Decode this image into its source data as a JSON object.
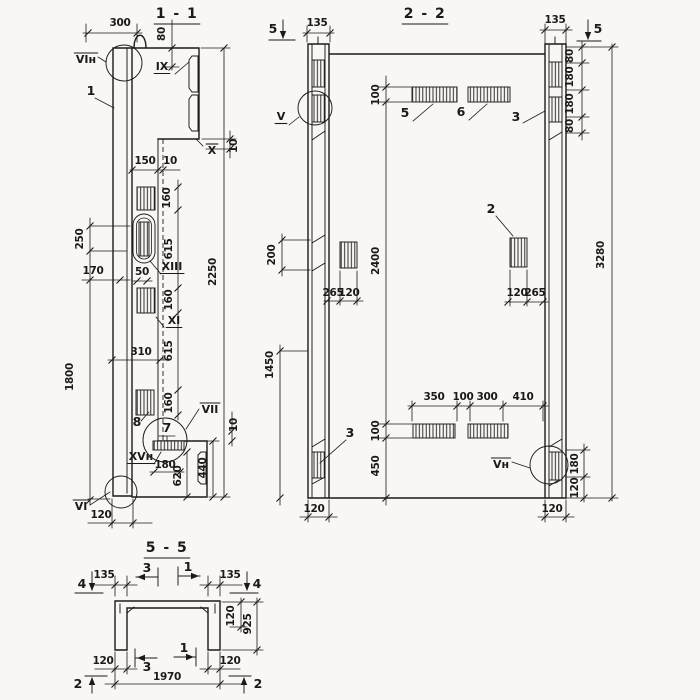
{
  "sheet": {
    "background": "#f8f7f3",
    "ink": "#1c1a18"
  },
  "sections": [
    {
      "id": "1-1",
      "name": "section-1-1",
      "labels": [
        {
          "t": "1 - 1",
          "x": 177,
          "y": 18,
          "k": "title",
          "ln": "u"
        },
        {
          "t": "300",
          "x": 120,
          "y": 26,
          "k": "dim"
        },
        {
          "t": "VIн",
          "x": 86,
          "y": 63,
          "k": "detail",
          "ln": "o"
        },
        {
          "t": "1",
          "x": 91,
          "y": 95,
          "k": "part"
        },
        {
          "t": "80",
          "x": 165,
          "y": 34,
          "k": "dim",
          "r": -90
        },
        {
          "t": "IX",
          "x": 162,
          "y": 70,
          "k": "detail",
          "ln": "u"
        },
        {
          "t": "10",
          "x": 237,
          "y": 146,
          "k": "dim",
          "r": -90
        },
        {
          "t": "X",
          "x": 212,
          "y": 154,
          "k": "detail",
          "ln": "o"
        },
        {
          "t": "150",
          "x": 145,
          "y": 164,
          "k": "dim"
        },
        {
          "t": "10",
          "x": 170,
          "y": 164,
          "k": "dim"
        },
        {
          "t": "160",
          "x": 170,
          "y": 198,
          "k": "dim",
          "r": -90
        },
        {
          "t": "615",
          "x": 172,
          "y": 249,
          "k": "dim",
          "r": -90
        },
        {
          "t": "2250",
          "x": 216,
          "y": 272,
          "k": "dim",
          "r": -90
        },
        {
          "t": "250",
          "x": 83,
          "y": 239,
          "k": "dim",
          "r": -90
        },
        {
          "t": "170",
          "x": 93,
          "y": 274,
          "k": "dim"
        },
        {
          "t": "50",
          "x": 142,
          "y": 275,
          "k": "dim"
        },
        {
          "t": "XIII",
          "x": 172,
          "y": 270,
          "k": "detail",
          "ln": "u"
        },
        {
          "t": "160",
          "x": 172,
          "y": 300,
          "k": "dim",
          "r": -90
        },
        {
          "t": "XI",
          "x": 174,
          "y": 324,
          "k": "detail",
          "ln": "u"
        },
        {
          "t": "310",
          "x": 141,
          "y": 355,
          "k": "dim"
        },
        {
          "t": "615",
          "x": 172,
          "y": 351,
          "k": "dim",
          "r": -90
        },
        {
          "t": "1800",
          "x": 73,
          "y": 377,
          "k": "dim",
          "r": -90
        },
        {
          "t": "160",
          "x": 172,
          "y": 403,
          "k": "dim",
          "r": -90
        },
        {
          "t": "8",
          "x": 137,
          "y": 426,
          "k": "part"
        },
        {
          "t": "7",
          "x": 167,
          "y": 432,
          "k": "part"
        },
        {
          "t": "VII",
          "x": 210,
          "y": 413,
          "k": "detail",
          "ln": "o"
        },
        {
          "t": "10",
          "x": 237,
          "y": 425,
          "k": "dim",
          "r": -90
        },
        {
          "t": "XVн",
          "x": 141,
          "y": 460,
          "k": "detail",
          "ln": "u"
        },
        {
          "t": "180",
          "x": 165,
          "y": 468,
          "k": "dim"
        },
        {
          "t": "620",
          "x": 181,
          "y": 476,
          "k": "dim",
          "r": -90
        },
        {
          "t": "440",
          "x": 206,
          "y": 468,
          "k": "dim",
          "r": -90
        },
        {
          "t": "VI",
          "x": 81,
          "y": 510,
          "k": "detail",
          "ln": "o"
        },
        {
          "t": "120",
          "x": 101,
          "y": 518,
          "k": "dim"
        }
      ]
    },
    {
      "id": "2-2",
      "name": "section-2-2",
      "labels": [
        {
          "t": "2 - 2",
          "x": 425,
          "y": 18,
          "k": "title",
          "ln": "u"
        },
        {
          "t": "5",
          "x": 273,
          "y": 33,
          "k": "marker"
        },
        {
          "t": "135",
          "x": 317,
          "y": 26,
          "k": "dim"
        },
        {
          "t": "V",
          "x": 281,
          "y": 120,
          "k": "detail",
          "ln": "u"
        },
        {
          "t": "100",
          "x": 379,
          "y": 95,
          "k": "dim",
          "r": -90
        },
        {
          "t": "5",
          "x": 405,
          "y": 117,
          "k": "part"
        },
        {
          "t": "6",
          "x": 461,
          "y": 116,
          "k": "part"
        },
        {
          "t": "3",
          "x": 516,
          "y": 121,
          "k": "part"
        },
        {
          "t": "135",
          "x": 555,
          "y": 23,
          "k": "dim"
        },
        {
          "t": "5",
          "x": 598,
          "y": 33,
          "k": "marker"
        },
        {
          "t": "80",
          "x": 573,
          "y": 56,
          "k": "dim",
          "r": -90
        },
        {
          "t": "180",
          "x": 573,
          "y": 77,
          "k": "dim",
          "r": -90
        },
        {
          "t": "180",
          "x": 573,
          "y": 104,
          "k": "dim",
          "r": -90
        },
        {
          "t": "80",
          "x": 573,
          "y": 126,
          "k": "dim",
          "r": -90
        },
        {
          "t": "3280",
          "x": 604,
          "y": 255,
          "k": "dim",
          "r": -90
        },
        {
          "t": "2",
          "x": 491,
          "y": 213,
          "k": "part"
        },
        {
          "t": "120",
          "x": 517,
          "y": 296,
          "k": "dim"
        },
        {
          "t": "265",
          "x": 535,
          "y": 296,
          "k": "dim"
        },
        {
          "t": "200",
          "x": 275,
          "y": 255,
          "k": "dim",
          "r": -90
        },
        {
          "t": "2400",
          "x": 379,
          "y": 261,
          "k": "dim",
          "r": -90
        },
        {
          "t": "265",
          "x": 333,
          "y": 296,
          "k": "dim"
        },
        {
          "t": "120",
          "x": 349,
          "y": 296,
          "k": "dim"
        },
        {
          "t": "1450",
          "x": 273,
          "y": 365,
          "k": "dim",
          "r": -90
        },
        {
          "t": "3",
          "x": 350,
          "y": 437,
          "k": "part"
        },
        {
          "t": "350",
          "x": 434,
          "y": 400,
          "k": "dim"
        },
        {
          "t": "100",
          "x": 463,
          "y": 400,
          "k": "dim"
        },
        {
          "t": "300",
          "x": 487,
          "y": 400,
          "k": "dim"
        },
        {
          "t": "410",
          "x": 523,
          "y": 400,
          "k": "dim"
        },
        {
          "t": "100",
          "x": 379,
          "y": 431,
          "k": "dim",
          "r": -90
        },
        {
          "t": "450",
          "x": 379,
          "y": 466,
          "k": "dim",
          "r": -90
        },
        {
          "t": "Vн",
          "x": 501,
          "y": 468,
          "k": "detail",
          "ln": "o"
        },
        {
          "t": "180",
          "x": 578,
          "y": 464,
          "k": "dim",
          "r": -90
        },
        {
          "t": "120",
          "x": 578,
          "y": 488,
          "k": "dim",
          "r": -90
        },
        {
          "t": "120",
          "x": 314,
          "y": 512,
          "k": "dim"
        },
        {
          "t": "120",
          "x": 552,
          "y": 512,
          "k": "dim"
        }
      ]
    },
    {
      "id": "5-5",
      "name": "section-5-5",
      "labels": [
        {
          "t": "5 - 5",
          "x": 167,
          "y": 552,
          "k": "title",
          "ln": "u"
        },
        {
          "t": "4",
          "x": 82,
          "y": 588,
          "k": "marker"
        },
        {
          "t": "135",
          "x": 104,
          "y": 578,
          "k": "dim"
        },
        {
          "t": "3",
          "x": 147,
          "y": 572,
          "k": "marker"
        },
        {
          "t": "1",
          "x": 188,
          "y": 571,
          "k": "marker"
        },
        {
          "t": "135",
          "x": 230,
          "y": 578,
          "k": "dim"
        },
        {
          "t": "4",
          "x": 257,
          "y": 588,
          "k": "marker"
        },
        {
          "t": "120",
          "x": 234,
          "y": 616,
          "k": "dim",
          "r": -90
        },
        {
          "t": "925",
          "x": 251,
          "y": 624,
          "k": "dim",
          "r": -90
        },
        {
          "t": "120",
          "x": 103,
          "y": 664,
          "k": "dim"
        },
        {
          "t": "3",
          "x": 147,
          "y": 671,
          "k": "marker"
        },
        {
          "t": "1",
          "x": 184,
          "y": 652,
          "k": "marker"
        },
        {
          "t": "120",
          "x": 230,
          "y": 664,
          "k": "dim"
        },
        {
          "t": "1970",
          "x": 167,
          "y": 680,
          "k": "dim"
        },
        {
          "t": "2",
          "x": 78,
          "y": 688,
          "k": "marker"
        },
        {
          "t": "2",
          "x": 258,
          "y": 688,
          "k": "marker"
        }
      ]
    }
  ]
}
